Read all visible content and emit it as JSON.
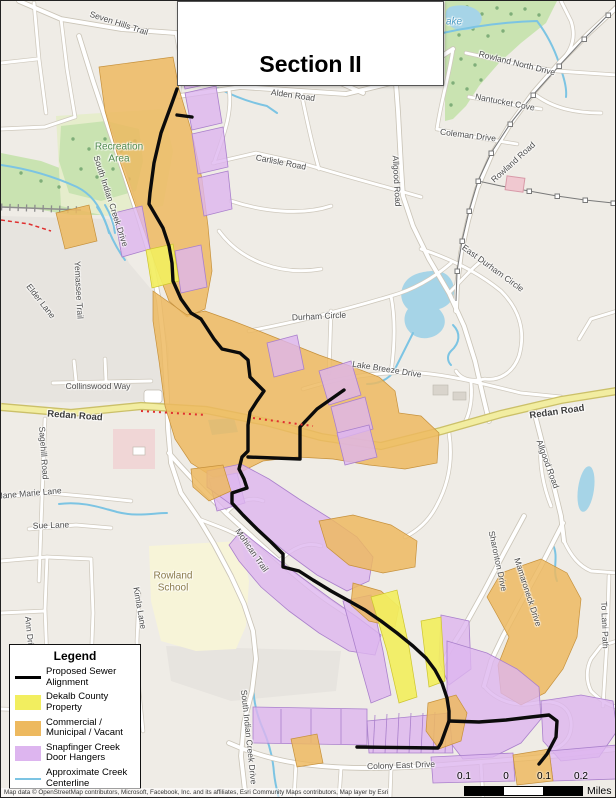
{
  "title": {
    "text": "Section II"
  },
  "legend": {
    "title": "Legend",
    "items": [
      {
        "label": "Proposed Sewer Alignment",
        "swatch": "line",
        "color": "#000000",
        "thickness": 3.5
      },
      {
        "label": "Dekalb County Property",
        "swatch": "rect",
        "color": "#f2ee5f"
      },
      {
        "label": "Commercial / Municipal / Vacant",
        "swatch": "rect",
        "color": "#edb95f"
      },
      {
        "label": "Snapfinger Creek Door Hangers",
        "swatch": "rect",
        "color": "#ddb5ef"
      },
      {
        "label": "Approximate Creek Centerline",
        "swatch": "line",
        "color": "#7cc4e3",
        "thickness": 2.5
      }
    ]
  },
  "scale_bar": {
    "tick_labels": [
      "0.1",
      "0",
      "0.1",
      "0.2"
    ],
    "unit": "Miles"
  },
  "attribution": "Map data © OpenStreetMap contributors, Microsoft, Facebook, Inc. and its affiliates, Esri Community Maps contributors, Map layer by Esri",
  "colors": {
    "sewer_black": "#0b0b0b",
    "county_yellow": "#f2ee5f",
    "commercial_orange": "#edb95f",
    "doorhanger_purple": "#ddb5ef",
    "creek_blue": "#7cc4e3",
    "water_fill": "#a6d4e7",
    "park_green": "#c9e3b1",
    "major_road_yellow": "#f2eda1"
  },
  "map": {
    "labels": [
      {
        "text": "Seven Hills Trail",
        "x": 118,
        "y": 22,
        "rot": 18,
        "kind": "road"
      },
      {
        "text": "Alden Road",
        "x": 292,
        "y": 94,
        "rot": 8,
        "kind": "road"
      },
      {
        "text": "Carlisle Road",
        "x": 280,
        "y": 161,
        "rot": 11,
        "kind": "road"
      },
      {
        "text": "Allgood Road",
        "x": 396,
        "y": 180,
        "rot": 87,
        "kind": "road"
      },
      {
        "text": "Allgood Road",
        "x": 547,
        "y": 463,
        "rot": 70,
        "kind": "road"
      },
      {
        "text": "Rowland North Drive",
        "x": 516,
        "y": 62,
        "rot": 14,
        "kind": "road"
      },
      {
        "text": "Nantucket Cove",
        "x": 504,
        "y": 101,
        "rot": 11,
        "kind": "road"
      },
      {
        "text": "Coleman Drive",
        "x": 467,
        "y": 134,
        "rot": 7,
        "kind": "road"
      },
      {
        "text": "Rowland Road",
        "x": 512,
        "y": 161,
        "rot": -42,
        "kind": "road"
      },
      {
        "text": "East Durham Circle",
        "x": 492,
        "y": 267,
        "rot": 36,
        "kind": "road"
      },
      {
        "text": "Durham Circle",
        "x": 318,
        "y": 315,
        "rot": -3,
        "kind": "road"
      },
      {
        "text": "Lake Breeze Drive",
        "x": 386,
        "y": 368,
        "rot": 9,
        "kind": "road"
      },
      {
        "text": "South Indian Creek Drive",
        "x": 110,
        "y": 200,
        "rot": 72,
        "kind": "road"
      },
      {
        "text": "Elder Lane",
        "x": 40,
        "y": 300,
        "rot": 52,
        "kind": "road"
      },
      {
        "text": "Yemassee Trail",
        "x": 78,
        "y": 289,
        "rot": 87,
        "kind": "road"
      },
      {
        "text": "Collinswood Way",
        "x": 97,
        "y": 385,
        "rot": 0,
        "kind": "road"
      },
      {
        "text": "Redan Road",
        "x": 74,
        "y": 415,
        "rot": 4,
        "kind": "major"
      },
      {
        "text": "Redan Road",
        "x": 556,
        "y": 411,
        "rot": -8,
        "kind": "major"
      },
      {
        "text": "Sagehill Road",
        "x": 43,
        "y": 452,
        "rot": 86,
        "kind": "road"
      },
      {
        "text": "Jane Marie Lane",
        "x": 29,
        "y": 492,
        "rot": -5,
        "kind": "road"
      },
      {
        "text": "Sue Lane",
        "x": 50,
        "y": 524,
        "rot": -2,
        "kind": "road"
      },
      {
        "text": "Mohican Trail",
        "x": 251,
        "y": 549,
        "rot": 55,
        "kind": "road"
      },
      {
        "text": "Kimla Lane",
        "x": 139,
        "y": 607,
        "rot": 80,
        "kind": "road"
      },
      {
        "text": "Sharonton Drive",
        "x": 497,
        "y": 560,
        "rot": 78,
        "kind": "road"
      },
      {
        "text": "Mamaroneck Drive",
        "x": 527,
        "y": 591,
        "rot": 72,
        "kind": "road"
      },
      {
        "text": "Colony East Drive",
        "x": 400,
        "y": 764,
        "rot": -2,
        "kind": "road"
      },
      {
        "text": "South Indian Creek Drive",
        "x": 248,
        "y": 736,
        "rot": 84,
        "kind": "road"
      },
      {
        "text": "To Lani Path",
        "x": 604,
        "y": 624,
        "rot": 88,
        "kind": "road"
      },
      {
        "text": "Ann Drive",
        "x": 29,
        "y": 634,
        "rot": 84,
        "kind": "road"
      },
      {
        "text": "Recreation\nArea",
        "x": 118,
        "y": 152,
        "rot": 0,
        "kind": "park"
      },
      {
        "text": "Rowland\nSchool",
        "x": 172,
        "y": 581,
        "rot": 0,
        "kind": "school"
      },
      {
        "text": "ake",
        "x": 453,
        "y": 21,
        "rot": 0,
        "kind": "water"
      }
    ]
  }
}
